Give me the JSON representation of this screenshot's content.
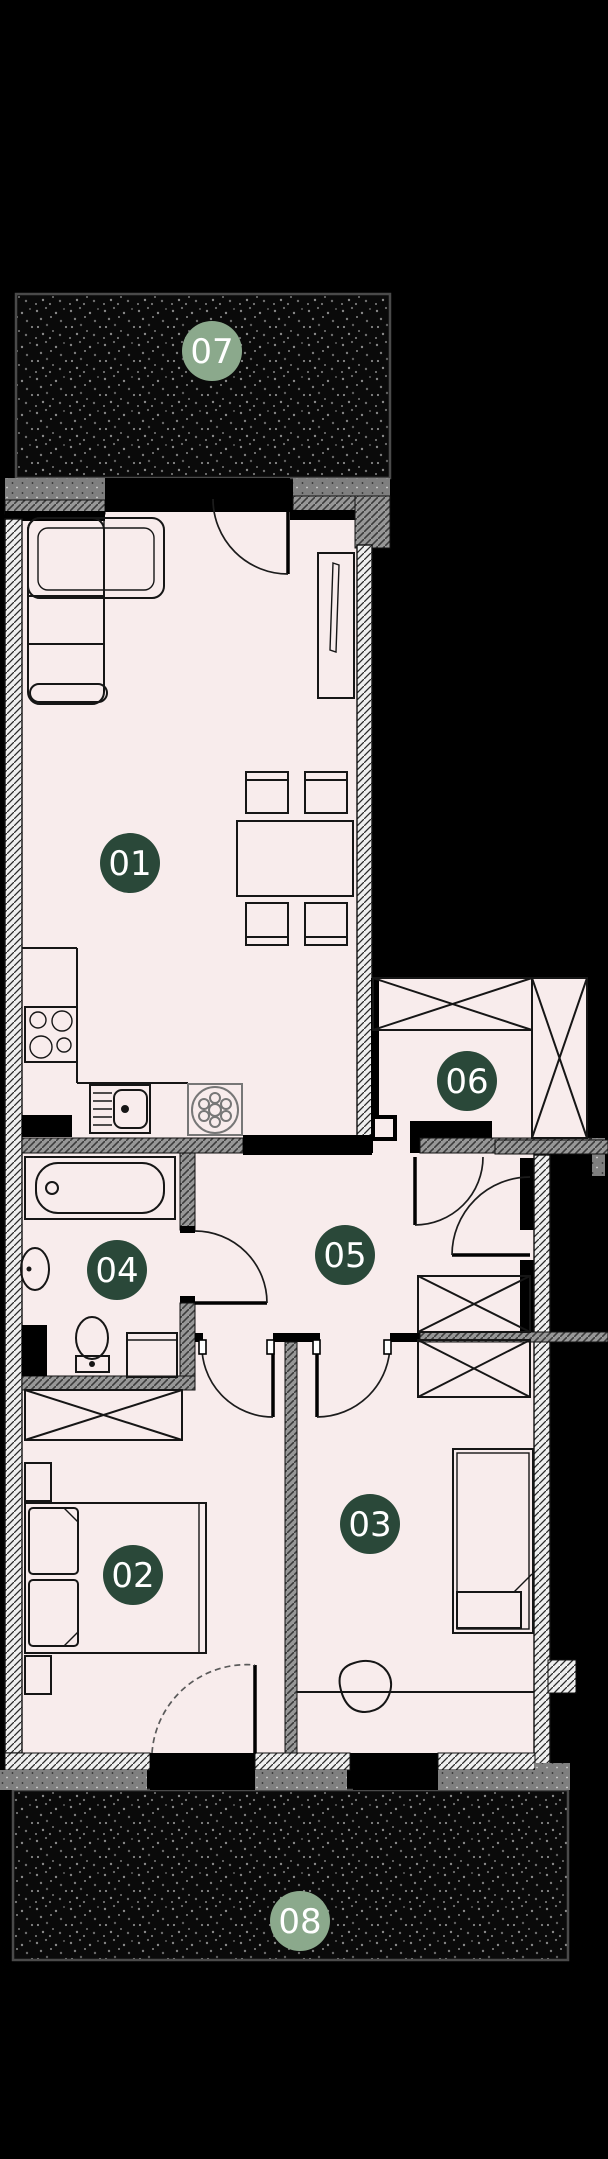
{
  "floorplan": {
    "badges": {
      "b01": {
        "label": "01",
        "style": "dark"
      },
      "b02": {
        "label": "02",
        "style": "dark"
      },
      "b03": {
        "label": "03",
        "style": "dark"
      },
      "b04": {
        "label": "04",
        "style": "dark"
      },
      "b05": {
        "label": "05",
        "style": "dark"
      },
      "b06": {
        "label": "06",
        "style": "dark"
      },
      "b07": {
        "label": "07",
        "style": "light"
      },
      "b08": {
        "label": "08",
        "style": "light"
      }
    },
    "colors": {
      "badge_dark": "#2a4839",
      "badge_light": "#8ba98c",
      "badge_text": "#ffffff",
      "floor": "#f8ecec",
      "wall": "#000000",
      "terrace_fill": "#0a0a0a",
      "terrace_speckle": "#808080",
      "terrace_border": "#4a4a4a",
      "hatch_light": "#efefef",
      "hatch_gray": "#979797"
    }
  }
}
